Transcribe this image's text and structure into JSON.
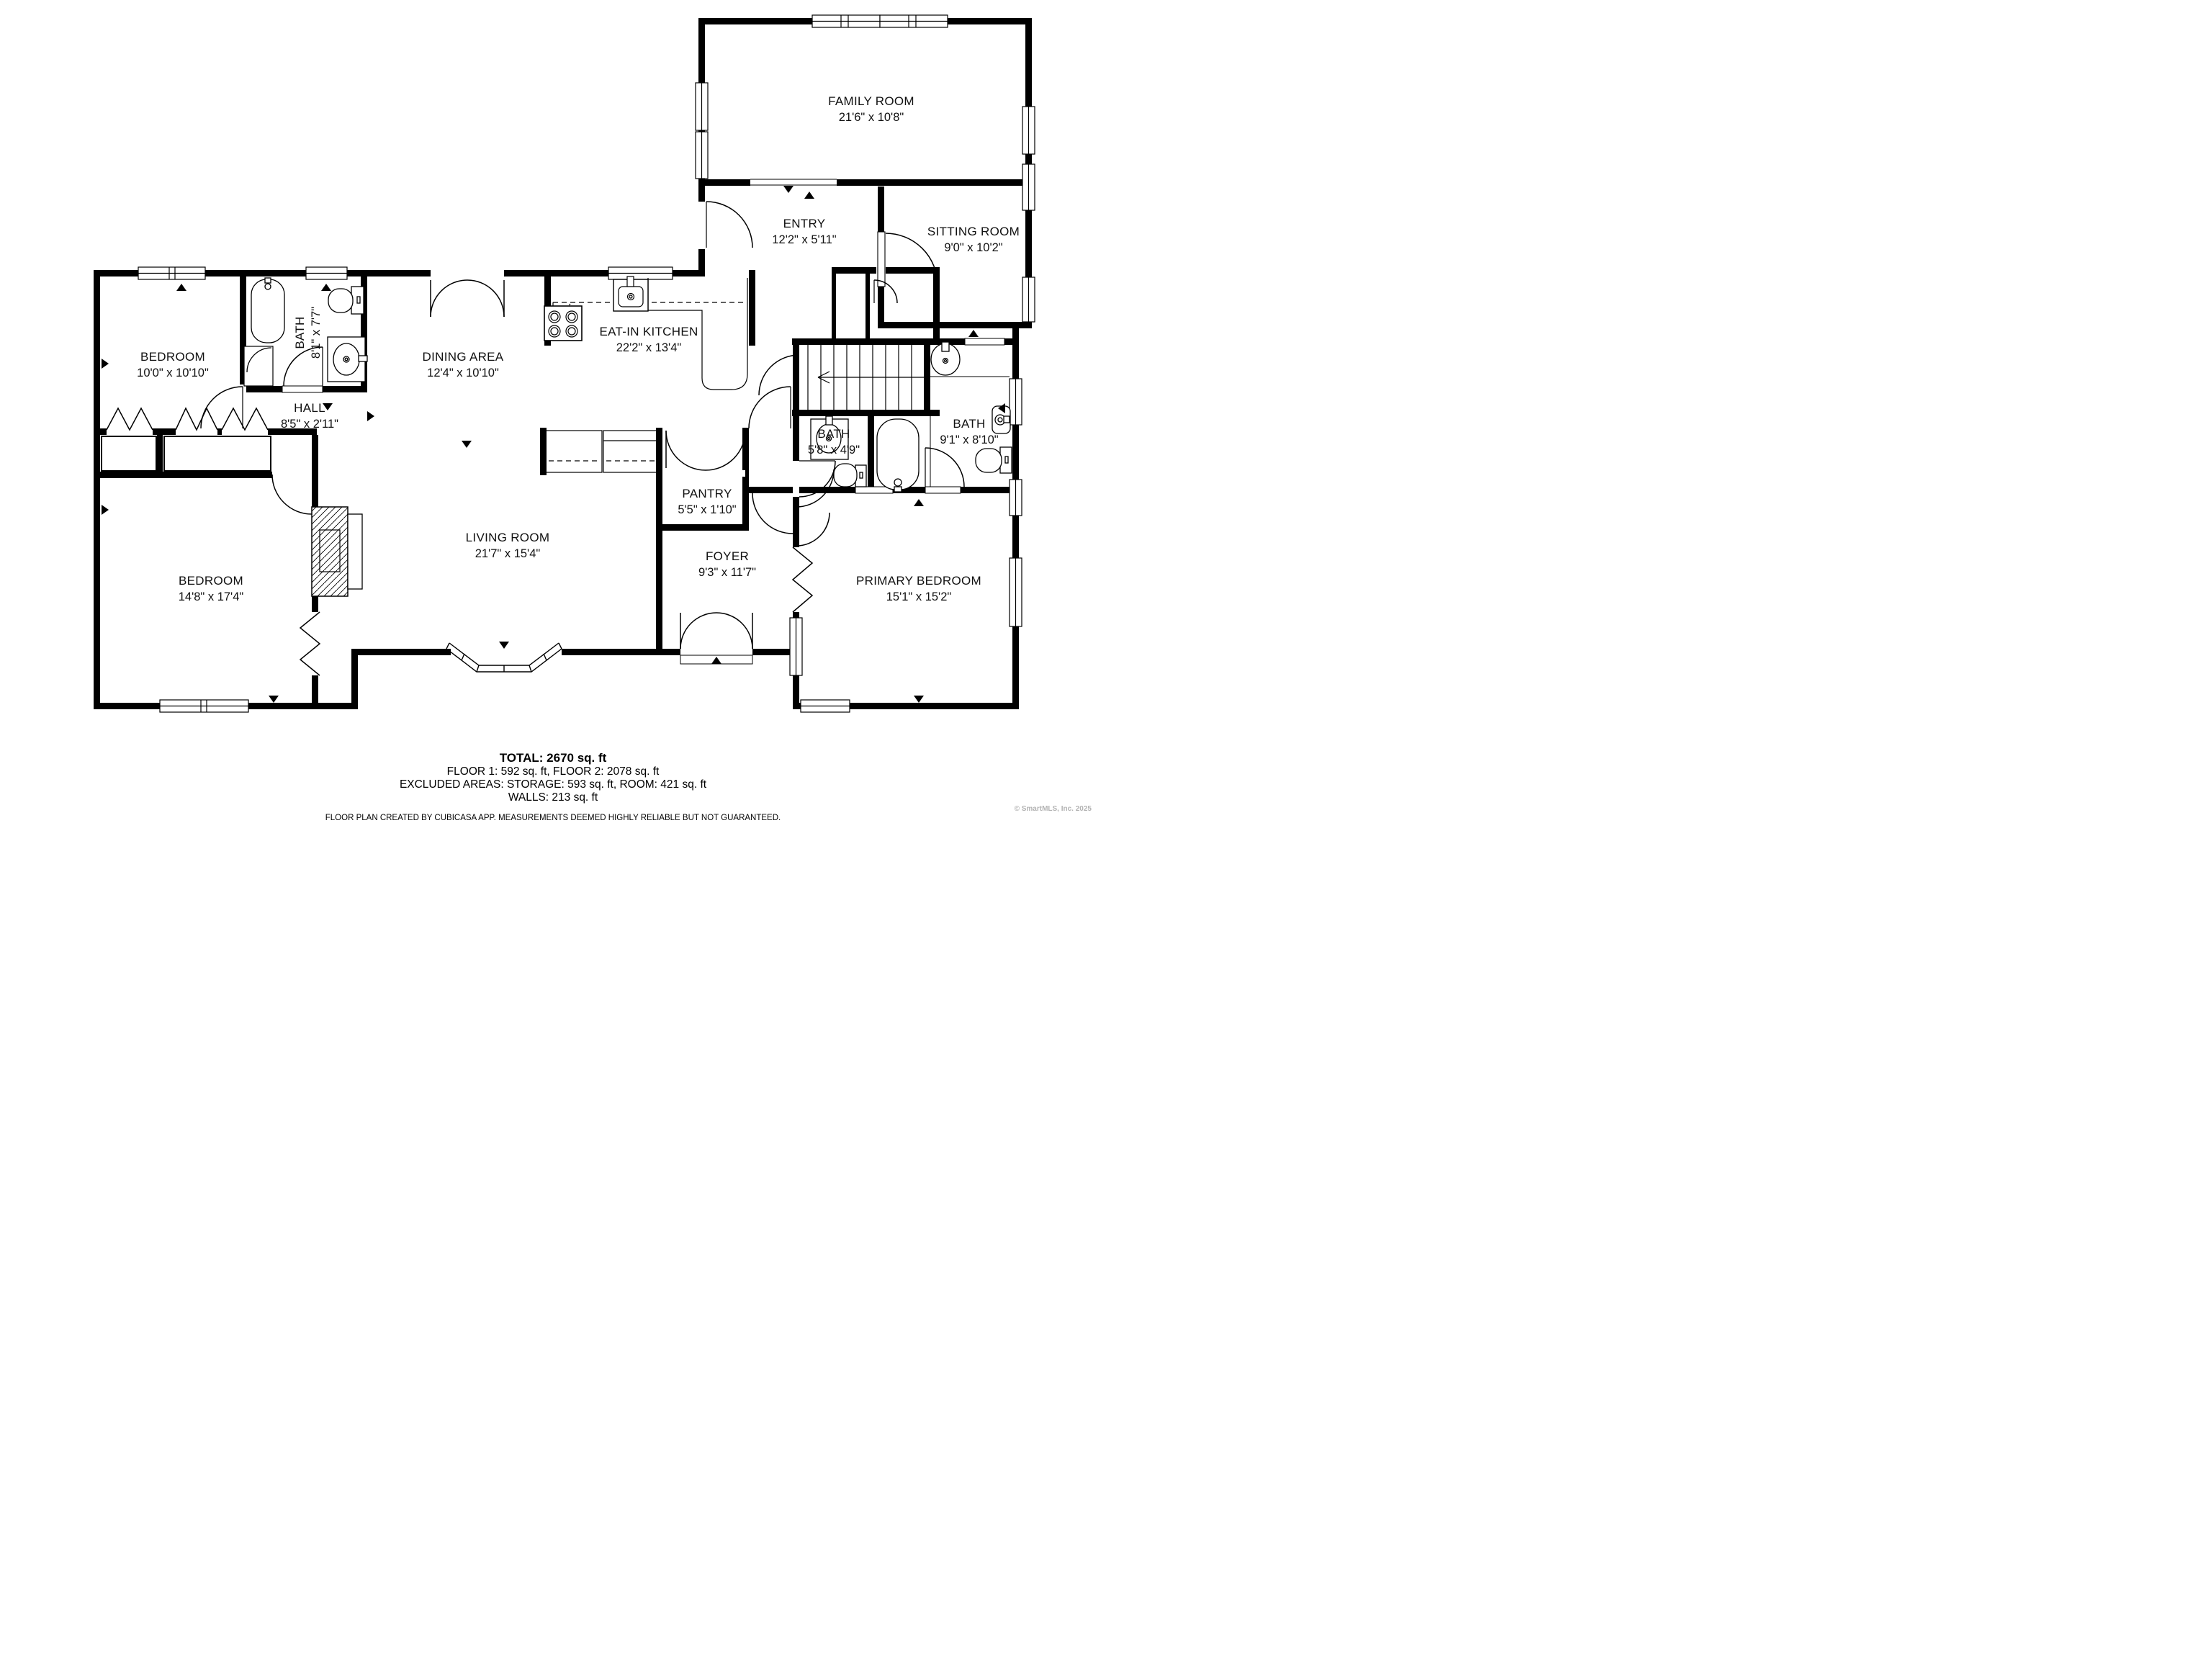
{
  "plan": {
    "rooms": [
      {
        "name": "FAMILY ROOM",
        "dims": "21'6\" x 10'8\""
      },
      {
        "name": "ENTRY",
        "dims": "12'2\" x 5'11\""
      },
      {
        "name": "SITTING ROOM",
        "dims": "9'0\" x 10'2\""
      },
      {
        "name": "BEDROOM",
        "dims": "10'0\" x 10'10\""
      },
      {
        "name": "BATH",
        "dims": "8'1\" x 7'7\""
      },
      {
        "name": "DINING AREA",
        "dims": "12'4\" x 10'10\""
      },
      {
        "name": "EAT-IN KITCHEN",
        "dims": "22'2\" x 13'4\""
      },
      {
        "name": "HALL",
        "dims": "8'5\" x 2'11\""
      },
      {
        "name": "PANTRY",
        "dims": "5'5\" x 1'10\""
      },
      {
        "name": "BATH",
        "dims": "5'8\" x 4'9\""
      },
      {
        "name": "BATH",
        "dims": "9'1\" x 8'10\""
      },
      {
        "name": "BEDROOM",
        "dims": "14'8\" x 17'4\""
      },
      {
        "name": "LIVING ROOM",
        "dims": "21'7\" x 15'4\""
      },
      {
        "name": "FOYER",
        "dims": "9'3\" x 11'7\""
      },
      {
        "name": "PRIMARY BEDROOM",
        "dims": "15'1\" x 15'2\""
      }
    ],
    "summary": {
      "total": "TOTAL: 2670 sq. ft",
      "floors": "FLOOR 1: 592 sq. ft, FLOOR 2: 2078 sq. ft",
      "excluded": "EXCLUDED AREAS: STORAGE: 593 sq. ft, ROOM: 421 sq. ft",
      "walls": "WALLS: 213 sq. ft"
    },
    "disclaimer": "FLOOR PLAN CREATED BY CUBICASA APP. MEASUREMENTS DEEMED HIGHLY RELIABLE BUT NOT GUARANTEED.",
    "copyright": "© SmartMLS, Inc.  2025"
  }
}
